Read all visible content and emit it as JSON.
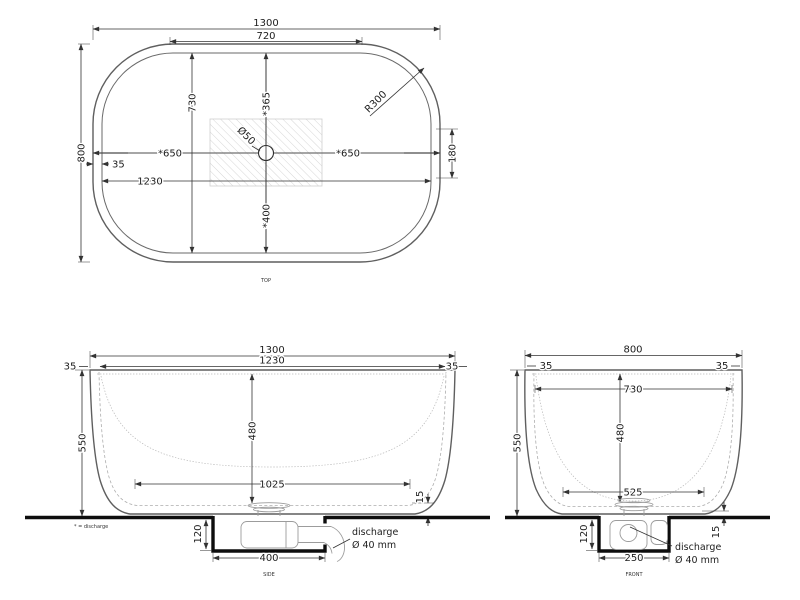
{
  "drawing": {
    "views": {
      "top": {
        "label": "TOP",
        "d1300": "1300",
        "d720": "720",
        "d800": "800",
        "d730": "730",
        "d365": "*365",
        "d400": "*400",
        "d650_left": "*650",
        "d650_right": "*650",
        "d50": "Ø50",
        "r300": "R300",
        "d180": "180",
        "d35": "35",
        "d1230": "1230"
      },
      "side": {
        "label": "SIDE",
        "footnote": "* = discharge",
        "d1300": "1300",
        "d1230": "1230",
        "d35_left": "35",
        "d35_right": "35",
        "d550": "550",
        "d480": "480",
        "d1025": "1025",
        "d15": "15",
        "d120": "120",
        "d400": "400",
        "discharge_line1": "discharge",
        "discharge_line2": "Ø 40 mm"
      },
      "front": {
        "label": "FRONT",
        "d800": "800",
        "d35_left": "35",
        "d35_right": "35",
        "d730": "730",
        "d550": "550",
        "d480": "480",
        "d525": "525",
        "d15": "15",
        "d120": "120",
        "d250": "250",
        "discharge_line1": "discharge",
        "discharge_line2": "Ø 40 mm"
      }
    },
    "colors": {
      "line": "#5f5f5f",
      "dimension": "#333333",
      "heavy": "#0d0d0d",
      "hatch": "#d6d6d6",
      "background": "#ffffff"
    }
  }
}
